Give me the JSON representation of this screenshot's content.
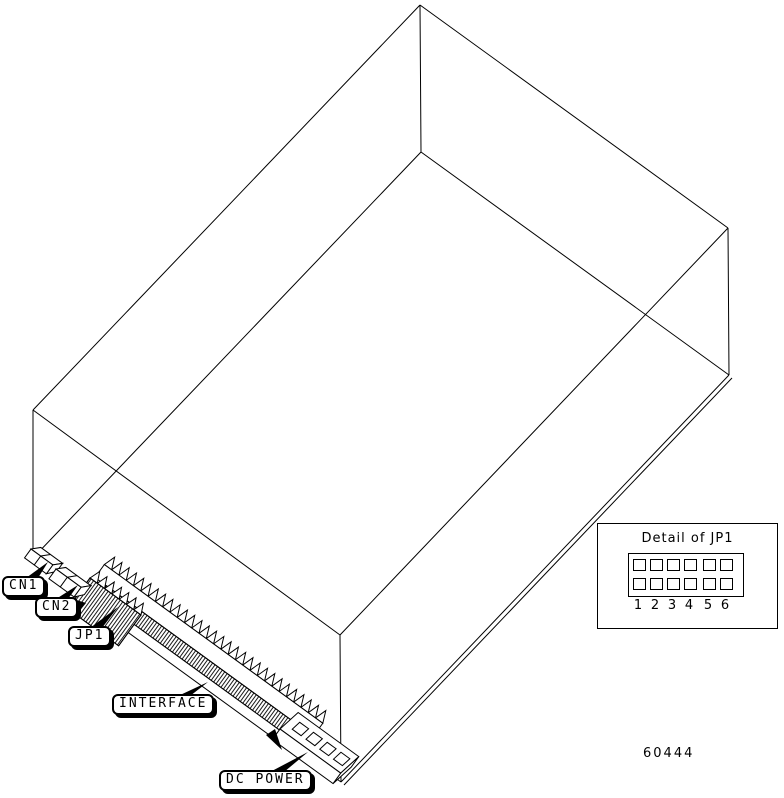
{
  "figure": {
    "id_number": "60444",
    "line_color": "#000000",
    "background_color": "#ffffff"
  },
  "callouts": [
    {
      "id": "cn1",
      "label": "CN1"
    },
    {
      "id": "cn2",
      "label": "CN2"
    },
    {
      "id": "jp1",
      "label": "JP1"
    },
    {
      "id": "interface",
      "label": "INTERFACE"
    },
    {
      "id": "dc_power",
      "label": "DC POWER"
    }
  ],
  "detail_inset": {
    "title": "Detail of JP1",
    "pin_rows": 2,
    "pin_columns": 6,
    "pin_numbers": [
      "1",
      "2",
      "3",
      "4",
      "5",
      "6"
    ]
  },
  "icons": [
    {
      "name": "pin1-arrow-jp1",
      "meaning": "pin 1 indicator arrow"
    },
    {
      "name": "pin1-arrow-dc-power",
      "meaning": "pin 1 indicator arrow"
    }
  ]
}
